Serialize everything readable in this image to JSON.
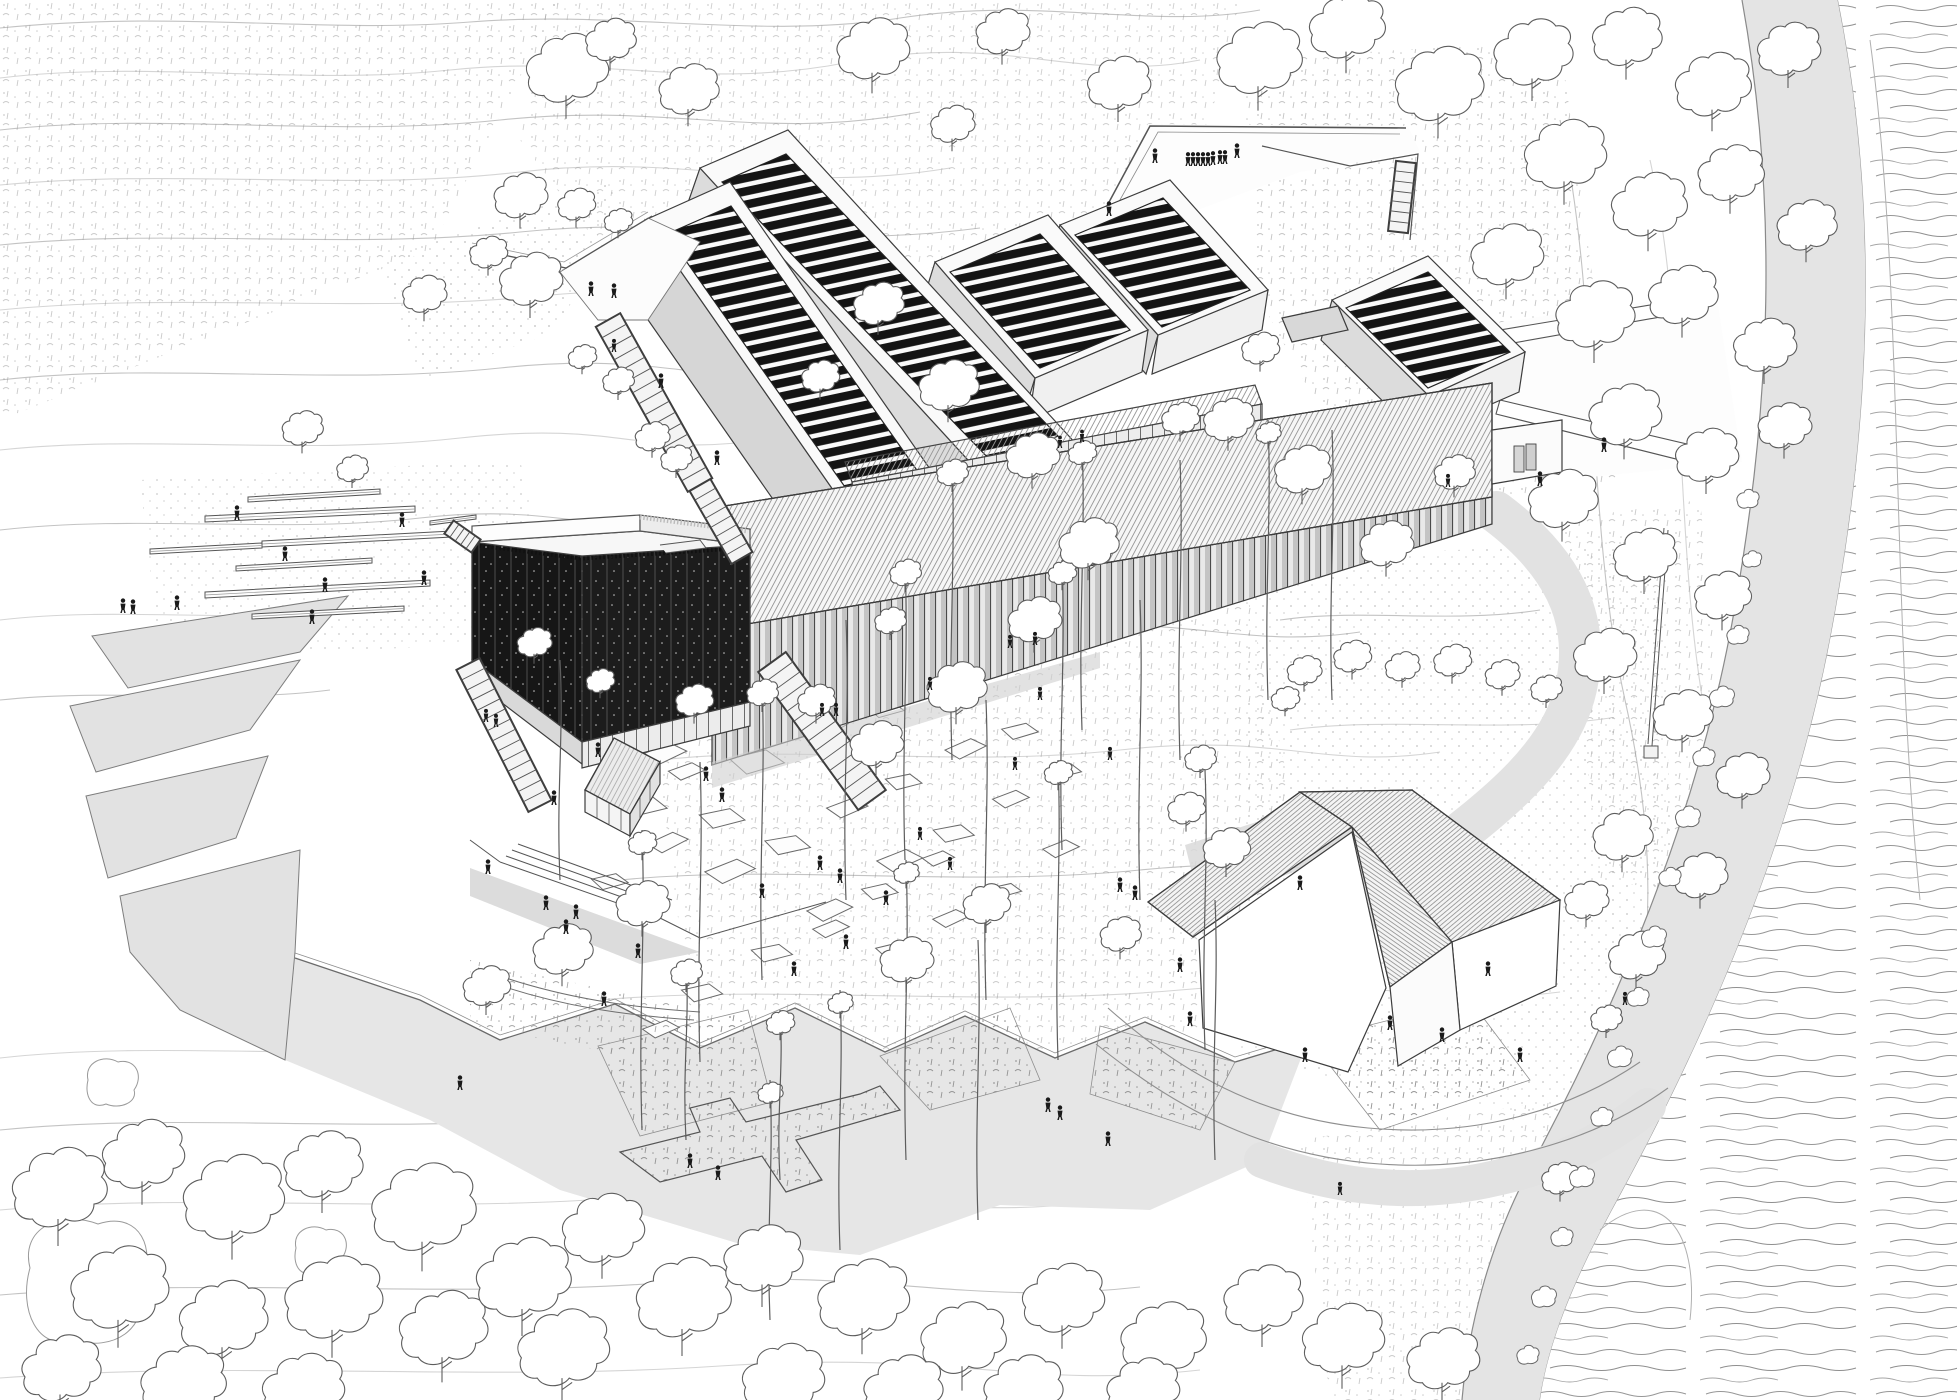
{
  "meta": {
    "description": "Aerial axonometric architectural line drawing of a museum complex in a landscape: five gallery volumes with black louvered roofs, a dark perforated cube, a long colonnade bar, terraces, stairs, plazas with scattered visitors, a pitched-roof house, contoured meadows, a curving road and a river"
  },
  "palette": {
    "paper": "#ffffff",
    "ink": "#3d3d3d",
    "ink_soft": "#6f6f6f",
    "contour": "#c3c3c3",
    "contour_light": "#dadada",
    "fill_light": "#efefef",
    "fill_mid": "#dcdcdc",
    "fill_shadow": "#cfcfcf",
    "road": "#e4e4e4",
    "plaza": "#e6e6e6",
    "louver_black": "#141414",
    "cube_black": "#161616",
    "figure": "#1a1a1a",
    "water_line": "#979797"
  },
  "scene": {
    "contours": [
      "M0,28 C180,10 320,34 470,22 S760,40 900,18 S1150,30 1260,10",
      "M0,78 C150,60 300,86 450,70 S700,92 850,62 S1080,84 1200,60",
      "M0,130 C160,112 330,138 500,120 S760,142 920,112",
      "M0,185 C180,168 350,192 520,172 S780,196 950,168",
      "M0,245 C170,228 340,250 520,232 S800,252 980,228",
      "M0,310 C180,292 360,314 540,296 S820,316 1000,292",
      "M0,380 C160,362 330,386 500,368 S700,390 820,368",
      "M0,450 C150,434 300,456 460,438 S640,458 760,440",
      "M0,530 C140,514 280,534 420,518 S600,538 700,522",
      "M0,620 C120,606 240,624 360,610",
      "M0,700 C110,688 220,704 330,690",
      "M0,1058 C160,1040 330,1062 520,1046 S800,1070 980,1050",
      "M0,1130 C180,1112 360,1134 560,1118 S860,1142 1040,1122",
      "M0,1210 C200,1192 400,1214 620,1198 S920,1222 1100,1202",
      "M0,1295 C220,1277 440,1299 660,1283 S960,1307 1140,1287",
      "M0,1378 C240,1360 480,1382 720,1366 S1020,1390 1200,1370",
      "M640,640 C760,624 900,648 1040,630 S1240,650 1360,632",
      "M660,760 C800,744 960,768 1120,750 S1320,770 1440,752",
      "M620,880 C780,864 960,888 1140,870 S1360,890 1480,872",
      "M600,1000 C780,984 980,1008 1180,990 S1420,1010 1560,992",
      "M1280,620 C1360,608 1450,624 1540,610",
      "M1290,730 C1390,716 1500,734 1610,718",
      "M1560,120 C1600,300 1585,520 1625,700 S1650,1000 1600,1200",
      "M1650,160 C1690,340 1672,560 1710,740 S1730,1020 1680,1240"
    ],
    "canopy_trees": [
      [
        566,
        72,
        1.3
      ],
      [
        688,
        92,
        0.95
      ],
      [
        610,
        42,
        0.8
      ],
      [
        872,
        52,
        1.15
      ],
      [
        1002,
        34,
        0.85
      ],
      [
        1118,
        86,
        1.0
      ],
      [
        952,
        126,
        0.7
      ],
      [
        520,
        198,
        0.85
      ],
      [
        576,
        206,
        0.6
      ],
      [
        618,
        222,
        0.45
      ],
      [
        424,
        296,
        0.7
      ],
      [
        530,
        282,
        1.0
      ],
      [
        488,
        254,
        0.6
      ],
      [
        302,
        430,
        0.65
      ],
      [
        352,
        470,
        0.5
      ],
      [
        582,
        358,
        0.45
      ],
      [
        618,
        382,
        0.5
      ],
      [
        652,
        438,
        0.55
      ],
      [
        676,
        460,
        0.5
      ],
      [
        878,
        306,
        0.8
      ],
      [
        948,
        388,
        0.95
      ],
      [
        1032,
        458,
        0.85
      ],
      [
        820,
        378,
        0.6
      ],
      [
        1088,
        546,
        0.95
      ],
      [
        1034,
        622,
        0.85
      ],
      [
        956,
        690,
        0.95
      ],
      [
        876,
        746,
        0.85
      ],
      [
        816,
        702,
        0.6
      ],
      [
        890,
        622,
        0.5
      ],
      [
        1228,
        422,
        0.8
      ],
      [
        1302,
        472,
        0.9
      ],
      [
        1386,
        546,
        0.85
      ],
      [
        1454,
        474,
        0.65
      ],
      [
        1260,
        350,
        0.6
      ],
      [
        1180,
        420,
        0.6
      ],
      [
        1258,
        62,
        1.35
      ],
      [
        1346,
        30,
        1.2
      ],
      [
        1438,
        88,
        1.4
      ],
      [
        1532,
        56,
        1.25
      ],
      [
        1626,
        40,
        1.1
      ],
      [
        1712,
        88,
        1.2
      ],
      [
        1788,
        52,
        1.0
      ],
      [
        1564,
        158,
        1.3
      ],
      [
        1648,
        208,
        1.2
      ],
      [
        1730,
        176,
        1.05
      ],
      [
        1806,
        228,
        0.95
      ],
      [
        1506,
        258,
        1.15
      ],
      [
        1594,
        318,
        1.25
      ],
      [
        1682,
        298,
        1.1
      ],
      [
        1764,
        348,
        1.0
      ],
      [
        1624,
        418,
        1.15
      ],
      [
        1706,
        458,
        1.0
      ],
      [
        1784,
        428,
        0.85
      ],
      [
        1562,
        502,
        1.1
      ],
      [
        1644,
        558,
        1.0
      ],
      [
        1722,
        598,
        0.9
      ],
      [
        1604,
        658,
        1.0
      ],
      [
        1682,
        718,
        0.95
      ],
      [
        1742,
        778,
        0.85
      ],
      [
        1622,
        838,
        0.95
      ],
      [
        1700,
        878,
        0.85
      ],
      [
        1636,
        958,
        0.9
      ],
      [
        1586,
        902,
        0.7
      ],
      [
        1304,
        672,
        0.55
      ],
      [
        1352,
        658,
        0.6
      ],
      [
        1402,
        668,
        0.55
      ],
      [
        1452,
        662,
        0.6
      ],
      [
        1502,
        676,
        0.55
      ],
      [
        1546,
        690,
        0.5
      ],
      [
        1285,
        700,
        0.45
      ],
      [
        1186,
        810,
        0.6
      ],
      [
        1226,
        850,
        0.75
      ],
      [
        1200,
        760,
        0.5
      ],
      [
        1606,
        1020,
        0.5
      ],
      [
        642,
        906,
        0.85
      ],
      [
        562,
        952,
        0.95
      ],
      [
        486,
        988,
        0.75
      ],
      [
        906,
        962,
        0.85
      ],
      [
        986,
        906,
        0.75
      ],
      [
        1120,
        936,
        0.65
      ],
      [
        694,
        702,
        0.6
      ],
      [
        534,
        644,
        0.55
      ],
      [
        600,
        682,
        0.45
      ],
      [
        58,
        1192,
        1.5
      ],
      [
        142,
        1158,
        1.3
      ],
      [
        232,
        1202,
        1.6
      ],
      [
        322,
        1168,
        1.25
      ],
      [
        422,
        1212,
        1.65
      ],
      [
        118,
        1292,
        1.55
      ],
      [
        222,
        1322,
        1.4
      ],
      [
        332,
        1302,
        1.55
      ],
      [
        442,
        1332,
        1.4
      ],
      [
        60,
        1372,
        1.25
      ],
      [
        182,
        1386,
        1.35
      ],
      [
        302,
        1392,
        1.3
      ],
      [
        522,
        1282,
        1.5
      ],
      [
        602,
        1232,
        1.3
      ],
      [
        562,
        1352,
        1.45
      ],
      [
        682,
        1302,
        1.5
      ],
      [
        762,
        1262,
        1.25
      ],
      [
        862,
        1302,
        1.45
      ],
      [
        962,
        1342,
        1.35
      ],
      [
        1062,
        1302,
        1.3
      ],
      [
        1162,
        1342,
        1.35
      ],
      [
        1262,
        1302,
        1.25
      ],
      [
        1342,
        1342,
        1.3
      ],
      [
        1442,
        1362,
        1.15
      ],
      [
        782,
        1382,
        1.3
      ],
      [
        902,
        1392,
        1.25
      ],
      [
        1022,
        1392,
        1.25
      ],
      [
        1142,
        1392,
        1.15
      ],
      [
        1560,
        1180,
        0.6
      ]
    ],
    "tall_trees": [
      [
        952,
        760,
        300,
        0.5
      ],
      [
        1082,
        730,
        290,
        0.45
      ],
      [
        1180,
        760,
        300,
        0
      ],
      [
        1268,
        700,
        280,
        0.4
      ],
      [
        1332,
        700,
        270,
        0
      ],
      [
        905,
        860,
        300,
        0.5
      ],
      [
        846,
        900,
        280,
        0
      ],
      [
        1062,
        850,
        290,
        0.45
      ],
      [
        1140,
        900,
        300,
        0
      ],
      [
        762,
        980,
        300,
        0.5
      ],
      [
        700,
        1062,
        300,
        0
      ],
      [
        642,
        1130,
        300,
        0.45
      ],
      [
        986,
        1000,
        300,
        0
      ],
      [
        1058,
        1060,
        300,
        0.45
      ],
      [
        1205,
        1050,
        280,
        0
      ],
      [
        906,
        1160,
        300,
        0.4
      ],
      [
        978,
        1220,
        280,
        0
      ],
      [
        840,
        1250,
        260,
        0.4
      ],
      [
        1215,
        1160,
        260,
        0
      ],
      [
        770,
        1320,
        240,
        0.4
      ],
      [
        560,
        880,
        220,
        0
      ],
      [
        686,
        1140,
        180,
        0.5
      ],
      [
        780,
        1180,
        170,
        0.45
      ]
    ],
    "bushes": [
      [
        1738,
        636,
        0.4
      ],
      [
        1722,
        698,
        0.45
      ],
      [
        1704,
        758,
        0.4
      ],
      [
        1688,
        818,
        0.45
      ],
      [
        1670,
        878,
        0.4
      ],
      [
        1654,
        938,
        0.45
      ],
      [
        1638,
        998,
        0.4
      ],
      [
        1620,
        1058,
        0.45
      ],
      [
        1602,
        1118,
        0.4
      ],
      [
        1582,
        1178,
        0.45
      ],
      [
        1562,
        1238,
        0.4
      ],
      [
        1544,
        1298,
        0.45
      ],
      [
        1528,
        1356,
        0.4
      ],
      [
        1748,
        500,
        0.4
      ],
      [
        1752,
        560,
        0.35
      ]
    ],
    "flagstones": [
      [
        628,
        652,
        1,
        -8
      ],
      [
        684,
        640,
        0.8,
        5
      ],
      [
        748,
        664,
        1.1,
        -4
      ],
      [
        692,
        708,
        0.9,
        8
      ],
      [
        640,
        746,
        1,
        -6
      ],
      [
        730,
        748,
        1.2,
        3
      ],
      [
        806,
        722,
        0.9,
        -10
      ],
      [
        868,
        700,
        0.8,
        4
      ],
      [
        926,
        688,
        0.7,
        -6
      ],
      [
        618,
        792,
        1.1,
        6
      ],
      [
        668,
        764,
        0.8,
        -3
      ],
      [
        700,
        806,
        1,
        5
      ],
      [
        646,
        836,
        0.9,
        -8
      ],
      [
        592,
        872,
        0.8,
        4
      ],
      [
        704,
        862,
        1.1,
        -5
      ],
      [
        766,
        832,
        1,
        7
      ],
      [
        826,
        800,
        0.9,
        -4
      ],
      [
        886,
        772,
        0.8,
        5
      ],
      [
        944,
        742,
        0.9,
        -7
      ],
      [
        1002,
        722,
        0.8,
        3
      ],
      [
        876,
        852,
        1,
        -5
      ],
      [
        934,
        822,
        0.9,
        6
      ],
      [
        992,
        792,
        0.8,
        -4
      ],
      [
        1050,
        762,
        0.7,
        5
      ],
      [
        806,
        902,
        1,
        -6
      ],
      [
        862,
        882,
        0.8,
        4
      ],
      [
        922,
        852,
        0.7,
        -3
      ],
      [
        752,
        942,
        0.9,
        5
      ],
      [
        812,
        922,
        0.8,
        -5
      ],
      [
        682,
        982,
        0.9,
        4
      ],
      [
        642,
        1022,
        0.8,
        -4
      ],
      [
        876,
        942,
        0.7,
        3
      ],
      [
        932,
        912,
        0.8,
        -6
      ],
      [
        990,
        882,
        0.7,
        4
      ],
      [
        1042,
        842,
        0.8,
        -5
      ]
    ],
    "benches": [
      [
        205,
        516,
        415,
        506,
        6
      ],
      [
        262,
        541,
        452,
        531,
        6
      ],
      [
        150,
        549,
        262,
        543,
        5
      ],
      [
        248,
        497,
        380,
        489,
        5
      ],
      [
        236,
        566,
        372,
        558,
        5
      ],
      [
        205,
        592,
        430,
        580,
        6
      ],
      [
        252,
        614,
        404,
        606,
        5
      ],
      [
        430,
        521,
        476,
        515,
        4
      ]
    ],
    "stairs": [
      {
        "x1": 608,
        "y1": 320,
        "x2": 700,
        "y2": 485,
        "w": 28,
        "n": 15
      },
      {
        "x1": 700,
        "y1": 485,
        "x2": 742,
        "y2": 558,
        "w": 24,
        "n": 8
      },
      {
        "x1": 468,
        "y1": 664,
        "x2": 540,
        "y2": 806,
        "w": 26,
        "n": 14
      },
      {
        "x1": 772,
        "y1": 662,
        "x2": 872,
        "y2": 800,
        "w": 34,
        "n": 14
      },
      {
        "x1": 449,
        "y1": 527,
        "x2": 476,
        "y2": 546,
        "w": 16,
        "n": 5
      },
      {
        "x1": 1406,
        "y1": 162,
        "x2": 1398,
        "y2": 232,
        "w": 20,
        "n": 7
      }
    ],
    "people": [
      [
        237,
        520,
        1
      ],
      [
        402,
        527,
        1
      ],
      [
        285,
        561,
        1
      ],
      [
        325,
        592,
        1
      ],
      [
        424,
        585,
        1
      ],
      [
        123,
        613,
        1
      ],
      [
        133,
        614,
        1
      ],
      [
        177,
        610,
        1
      ],
      [
        312,
        624,
        1
      ],
      [
        614,
        352,
        0.9
      ],
      [
        591,
        296,
        1
      ],
      [
        614,
        298,
        1
      ],
      [
        661,
        388,
        1
      ],
      [
        717,
        465,
        1
      ],
      [
        1109,
        216,
        1
      ],
      [
        1155,
        163,
        1
      ],
      [
        1188,
        166,
        0.95
      ],
      [
        1193,
        166,
        0.95
      ],
      [
        1198,
        166,
        0.95
      ],
      [
        1203,
        166,
        0.95
      ],
      [
        1208,
        166,
        0.95
      ],
      [
        1213,
        165,
        0.95
      ],
      [
        1220,
        164,
        0.95
      ],
      [
        1225,
        164,
        0.95
      ],
      [
        1237,
        158,
        1
      ],
      [
        1604,
        452,
        1
      ],
      [
        1060,
        448,
        0.85
      ],
      [
        1082,
        442,
        0.85
      ],
      [
        1540,
        486,
        1
      ],
      [
        1448,
        487,
        0.9
      ],
      [
        554,
        805,
        1
      ],
      [
        598,
        757,
        1
      ],
      [
        706,
        781,
        1
      ],
      [
        722,
        802,
        1
      ],
      [
        546,
        910,
        1
      ],
      [
        576,
        919,
        1
      ],
      [
        566,
        934,
        1
      ],
      [
        488,
        874,
        1
      ],
      [
        638,
        958,
        1
      ],
      [
        604,
        1006,
        1
      ],
      [
        486,
        722,
        0.9
      ],
      [
        496,
        727,
        0.9
      ],
      [
        822,
        716,
        0.9
      ],
      [
        836,
        716,
        0.9
      ],
      [
        762,
        898,
        1
      ],
      [
        820,
        870,
        1
      ],
      [
        840,
        883,
        1
      ],
      [
        846,
        949,
        1
      ],
      [
        794,
        976,
        1
      ],
      [
        886,
        905,
        1
      ],
      [
        920,
        840,
        0.9
      ],
      [
        950,
        870,
        0.9
      ],
      [
        1015,
        770,
        0.9
      ],
      [
        1040,
        700,
        0.9
      ],
      [
        1110,
        760,
        0.9
      ],
      [
        1120,
        892,
        1
      ],
      [
        1135,
        900,
        1
      ],
      [
        1180,
        972,
        1
      ],
      [
        930,
        690,
        0.9
      ],
      [
        1035,
        645,
        0.9
      ],
      [
        1010,
        648,
        0.9
      ],
      [
        1300,
        890,
        1
      ],
      [
        460,
        1090,
        1
      ],
      [
        690,
        1168,
        1
      ],
      [
        718,
        1180,
        1
      ],
      [
        1048,
        1112,
        1
      ],
      [
        1060,
        1120,
        1
      ],
      [
        1108,
        1146,
        1
      ],
      [
        1190,
        1026,
        1
      ],
      [
        1305,
        1062,
        1
      ],
      [
        1390,
        1030,
        1
      ],
      [
        1442,
        1042,
        1
      ],
      [
        1520,
        1062,
        1
      ],
      [
        1488,
        976,
        1
      ],
      [
        1625,
        1005,
        0.9
      ],
      [
        1340,
        1195,
        0.9
      ]
    ]
  }
}
